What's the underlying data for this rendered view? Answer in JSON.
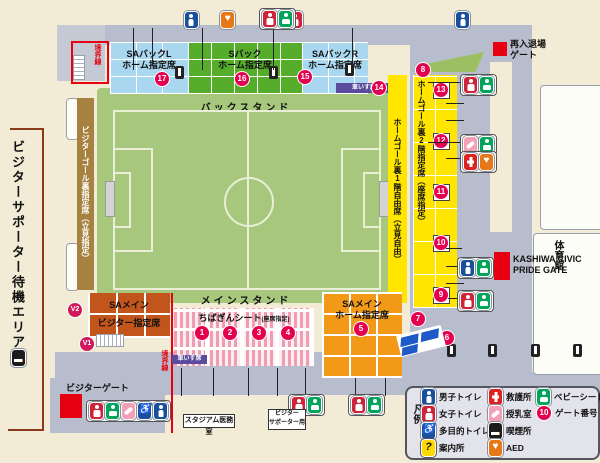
{
  "map": {
    "visitor_waiting_area": "ビジターサポーター待機エリア",
    "boundary_line_top": "境界線",
    "boundary_line_bottom": "境界線",
    "back_stand": "バックスタンド",
    "main_stand": "メインスタンド",
    "sections": {
      "visitor_goal_back": "ビジターゴール裏指定席（立見指定）",
      "sa_back_l_1": "SAバックL",
      "sa_back_l_2": "ホーム指定席",
      "s_back_1": "Sバック",
      "s_back_2": "ホーム指定席",
      "sa_back_r_1": "SAバックR",
      "sa_back_r_2": "ホーム指定席",
      "home_goal_1f": "ホームゴール裏1階自由席（立見自由）",
      "home_goal_2f": "ホームゴール裏2階指定席（座席指定）",
      "wheelchair_seats": "車いす席",
      "sa_main_visitor_1": "SAメイン",
      "sa_main_visitor_2": "ビジター指定席",
      "chibagin_1": "ちばぎんシート",
      "chibagin_2": "(座席指定)",
      "sa_main_home_1": "SAメイン",
      "sa_main_home_2": "ホーム指定席"
    },
    "facilities": {
      "gym": "体育館",
      "reentry_gate_1": "再入退場",
      "reentry_gate_2": "ゲート",
      "kashiwa_gate_1": "KASHIWA CIVIC",
      "kashiwa_gate_2": "PRIDE GATE",
      "visitor_gate": "ビジターゲート",
      "medical_room": "スタジアム医務室",
      "visitor_supporter_1": "ビジター",
      "visitor_supporter_2": "サポーター用"
    },
    "gates": {
      "n1": "1",
      "n2": "2",
      "n3": "3",
      "n4": "4",
      "n5": "5",
      "n6": "6",
      "n7": "7",
      "n8": "8",
      "n9": "9",
      "n10": "10",
      "n11": "11",
      "n12": "12",
      "n13": "13",
      "n14": "14",
      "n15": "15",
      "n16": "16",
      "n17": "17",
      "v1": "V1",
      "v2": "V2"
    }
  },
  "legend": {
    "title": "凡例",
    "gate_number_sample": "10",
    "items": [
      {
        "icon": "mens-toilet-icon",
        "label": "男子トイレ"
      },
      {
        "icon": "womens-toilet-icon",
        "label": "女子トイレ"
      },
      {
        "icon": "multipurpose-toilet-icon",
        "label": "多目的トイレ"
      },
      {
        "icon": "information-icon",
        "label": "案内所"
      },
      {
        "icon": "first-aid-icon",
        "label": "救護所"
      },
      {
        "icon": "nursing-room-icon",
        "label": "授乳室"
      },
      {
        "icon": "smoking-area-icon",
        "label": "喫煙所"
      },
      {
        "icon": "aed-icon",
        "label": "AED"
      },
      {
        "icon": "baby-seat-icon",
        "label": "ベビーシート"
      },
      {
        "icon": "gate-number-badge",
        "label": "ゲート番号"
      }
    ]
  },
  "colors": {
    "accent_red": "#e60012",
    "gate_badge": "#e5004f",
    "home_yellow": "#ffe500",
    "field_green": "#a6c77c",
    "walkway_gray": "#b7bdcc",
    "visitor_brick": "#c2551c",
    "home_orange": "#f29a18"
  }
}
